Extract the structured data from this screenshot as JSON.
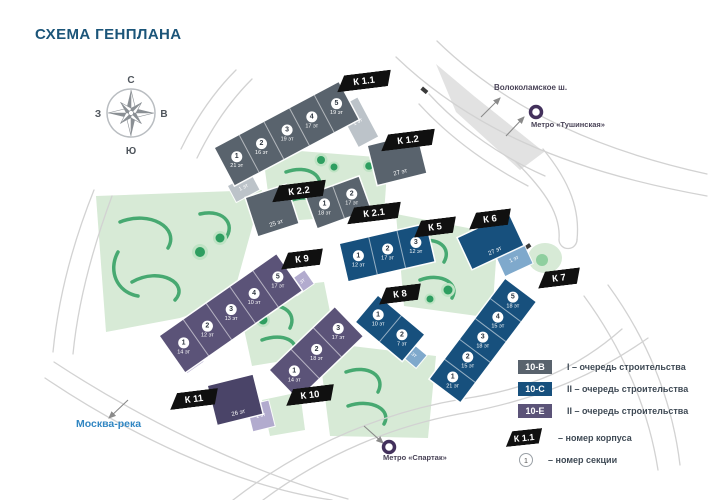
{
  "title": "СХЕМА ГЕНПЛАНА",
  "compass": {
    "n": "С",
    "s": "Ю",
    "w": "З",
    "e": "В"
  },
  "landmarks": {
    "highway": "Волоколамское ш.",
    "metro_tushinskaya": "Метро «Тушинская»",
    "metro_spartak": "Метро «Спартак»",
    "river": "Москва-река"
  },
  "buildings": [
    {
      "label": "К 1.1",
      "phase": "10-В",
      "sections": [
        {
          "num": "1",
          "floors": "21 эт"
        },
        {
          "num": "2",
          "floors": "16 эт"
        },
        {
          "num": "3",
          "floors": "19 эт"
        },
        {
          "num": "4",
          "floors": "17 эт"
        },
        {
          "num": "5",
          "floors": "19 эт"
        }
      ],
      "annexes": [
        "1 эт",
        "1 эт"
      ]
    },
    {
      "label": "К 1.2",
      "phase": "10-В",
      "floors": "27 эт"
    },
    {
      "label": "К 2.1",
      "phase": "10-В",
      "sections": [
        {
          "num": "1",
          "floors": "18 эт"
        },
        {
          "num": "2",
          "floors": "17 эт"
        }
      ]
    },
    {
      "label": "К 2.2",
      "phase": "10-В",
      "floors": "25 эт"
    },
    {
      "label": "К 5",
      "phase": "10-С",
      "sections": [
        {
          "num": "1",
          "floors": "12 эт"
        },
        {
          "num": "2",
          "floors": "17 эт"
        },
        {
          "num": "3",
          "floors": "12 эт"
        }
      ]
    },
    {
      "label": "К 6",
      "phase": "10-С",
      "floors": "27 эт",
      "annexes": [
        "1 эт"
      ]
    },
    {
      "label": "К 7",
      "phase": "10-С",
      "sections": [
        {
          "num": "1",
          "floors": "21 эт"
        },
        {
          "num": "2",
          "floors": "15 эт"
        },
        {
          "num": "3",
          "floors": "18 эт"
        },
        {
          "num": "4",
          "floors": "15 эт"
        },
        {
          "num": "5",
          "floors": "18 эт"
        }
      ]
    },
    {
      "label": "К 8",
      "phase": "10-С",
      "sections": [
        {
          "num": "1",
          "floors": "10 эт"
        },
        {
          "num": "2",
          "floors": "7 эт"
        }
      ],
      "annexes": [
        "1 эт"
      ]
    },
    {
      "label": "К 9",
      "phase": "10-Е",
      "sections": [
        {
          "num": "1",
          "floors": "14 эт"
        },
        {
          "num": "2",
          "floors": "12 эт"
        },
        {
          "num": "3",
          "floors": "13 эт"
        },
        {
          "num": "4",
          "floors": "10 эт"
        },
        {
          "num": "5",
          "floors": "17 эт"
        }
      ],
      "annexes": [
        "1 эт",
        "1 эт"
      ]
    },
    {
      "label": "К 10",
      "phase": "10-Е",
      "sections": [
        {
          "num": "1",
          "floors": "14 эт"
        },
        {
          "num": "2",
          "floors": "18 эт"
        },
        {
          "num": "3",
          "floors": "17 эт"
        }
      ]
    },
    {
      "label": "К 11",
      "phase": "10-Е",
      "floors": "26 эт",
      "annexes": [
        "1 эт"
      ]
    }
  ],
  "legend": {
    "items": [
      {
        "code": "10-В",
        "color": "#59636d",
        "text": "I – очередь строительства"
      },
      {
        "code": "10-С",
        "color": "#17507d",
        "text": "II – очередь строительства"
      },
      {
        "code": "10-Е",
        "color": "#5b5378",
        "text": "II – очередь строительства"
      }
    ],
    "korpus": {
      "tag": "К 1.1",
      "text": "– номер корпуса"
    },
    "section": {
      "symbol": "1",
      "text": "– номер секции"
    }
  },
  "colors": {
    "title": "#1b5579",
    "river_label": "#3186c2",
    "metro_icon": "#43315c",
    "phase_1": "#59636d",
    "phase_2": "#17507d",
    "phase_3": "#5b5378",
    "green_light": "#d7ead6",
    "green_dark": "#2e9e60"
  }
}
